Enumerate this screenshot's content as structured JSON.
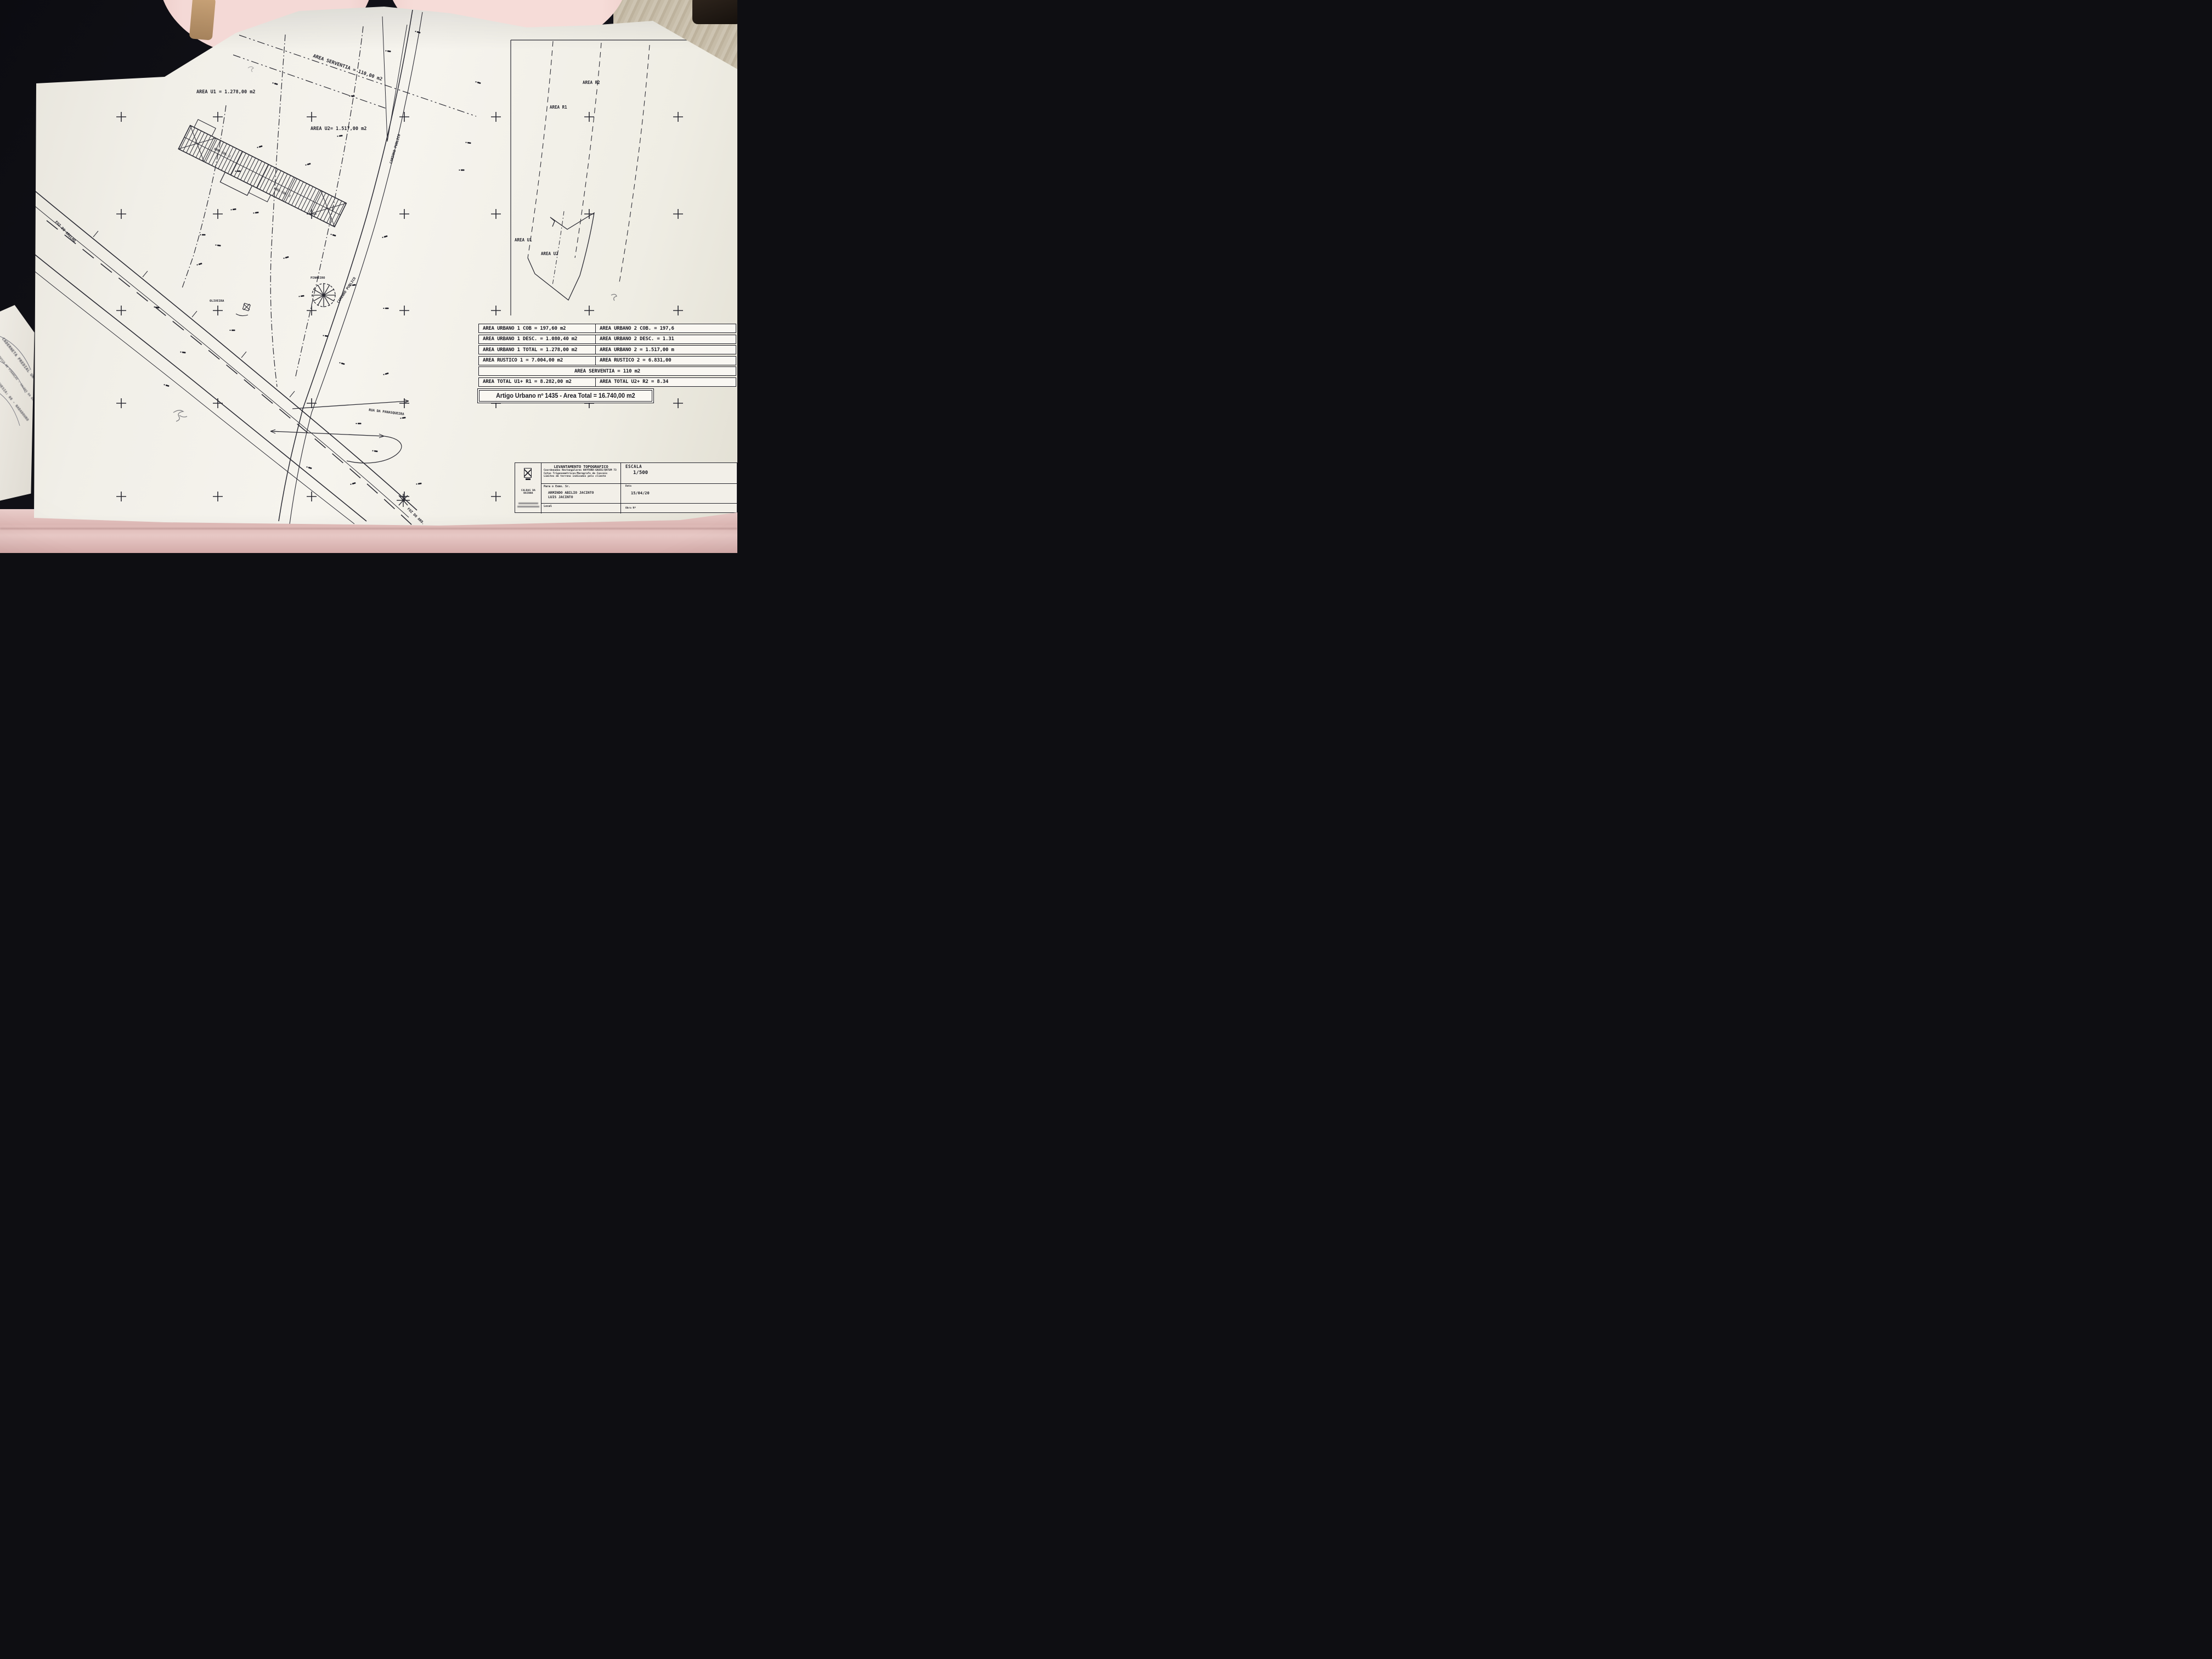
{
  "accent_colors": {
    "paper": "#f4f2ec",
    "ink": "#23232c",
    "fabric_pink": "#e9cdca",
    "carpet": "#c6bca8"
  },
  "main_plan": {
    "labels": {
      "area_serventia": "AREA SERVENTIA = 110,00 m2",
      "area_u1": "AREA U1 = 1.278,00 m2",
      "area_u2": "AREA U2= 1.517,00 m2",
      "caminho_publico": "CAMINHO PUBLICO",
      "rua_panasqueira": "RUA DA PANASQUEIRA",
      "foz_arelho": "FOZ DO ARELHO",
      "foz_aro": "FOZ DO ARO.",
      "pinheiro": "PINHEIRO",
      "oliveira": "OLIVEIRA",
      "cob1": "AREA COB. 1",
      "cob2": "AREA COB. 2"
    }
  },
  "inset_plan": {
    "labels": {
      "area_r2": "AREA R2",
      "area_r1": "AREA R1",
      "area_u1": "AREA U1",
      "area_u2": "AREA U2"
    }
  },
  "areas_table": {
    "rows_top": [
      {
        "left": "AREA URBANO 1 COB = 197,60 m2",
        "right": "AREA URBANO 2 COB. = 197,6"
      },
      {
        "left": "AREA URBANO 1 DESC. = 1.080,40 m2",
        "right": "AREA URBANO 2 DESC. = 1.31"
      },
      {
        "left": "AREA URBANO 1 TOTAL = 1.278,00 m2",
        "right": "AREA URBANO 2 = 1.517,00 m"
      },
      {
        "left": "AREA RUSTICO 1 = 7.004,00 m2",
        "right": "AREA RUSTICO 2 = 6.831,00"
      }
    ],
    "serventia_row": "AREA SERVENTIA = 110 m2",
    "total_row": {
      "left": "AREA TOTAL U1+ R1 = 8.282,00 m2",
      "right": "AREA TOTAL U2+ R2 = 8.34"
    },
    "banner": "Artigo Urbano nº 1435 - Area Total = 16.740,00 m2"
  },
  "title_block": {
    "title": "LEVANTAMENTO TOPOGRAFICO",
    "subtitle_lines": [
      "Coordenadas Rectangulares HAYFORD-GAUSS/DATUM 73",
      "Cotas Trigonometricas/Maregrafo de Cascais",
      "Limites de terreno indicados pelo cliente"
    ],
    "escala_label": "ESCALA",
    "escala_value": "1/500",
    "client_label": "Para o Exmo. Sr.",
    "client_name_1": "ARMINDO ABILIO JACINTO",
    "client_name_2": "LUIS JACINTO",
    "data_label": "Data",
    "data_value": "15/04/20",
    "local_label": "Local",
    "obra_label": "Obra Nº",
    "company_name": "CALDAS DA RAINHA"
  },
  "side_document": {
    "line1": "CADERNETA PREDIAL UR",
    "line2": "SERVIÇO DE FINANÇAS - CALDAS DA RAINHA",
    "line3": "FREGUESIA: 08 - NADADOURO"
  }
}
